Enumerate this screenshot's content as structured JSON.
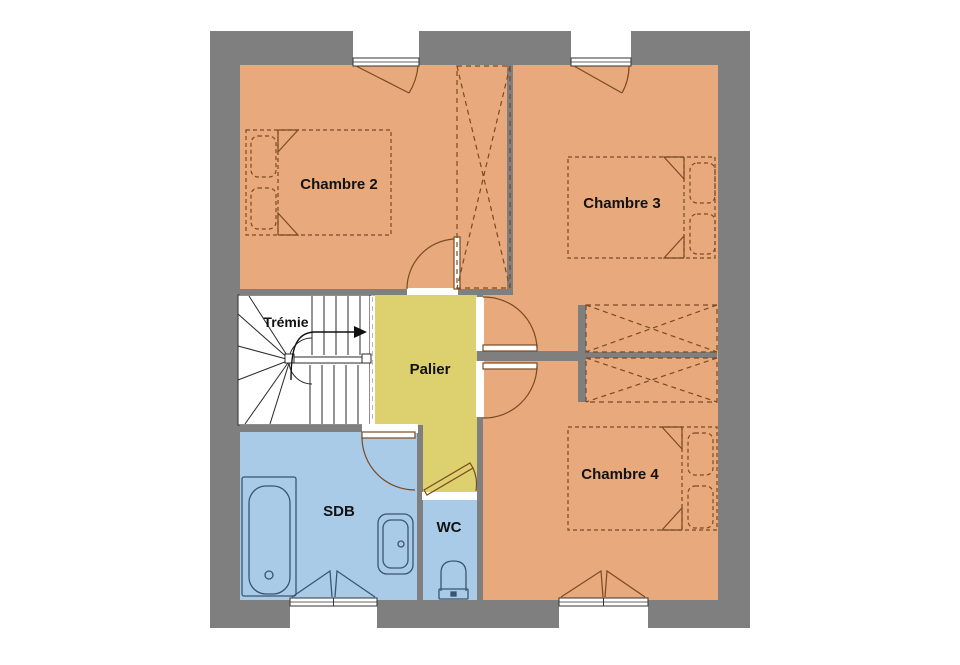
{
  "floorplan": {
    "labels": {
      "chambre2": "Chambre 2",
      "chambre3": "Chambre 3",
      "chambre4": "Chambre 4",
      "palier": "Palier",
      "tremie": "Trémie",
      "sdb": "SDB",
      "wc": "WC"
    },
    "colors": {
      "wall": "#7f7f7f",
      "bedroom": "#e8a97c",
      "landing": "#ddd06e",
      "bathroom": "#a9cbe8",
      "stairs": "#ffffff",
      "furniture": "#7b4a21",
      "fixtures": "#3a5570",
      "text": "#121212"
    }
  }
}
